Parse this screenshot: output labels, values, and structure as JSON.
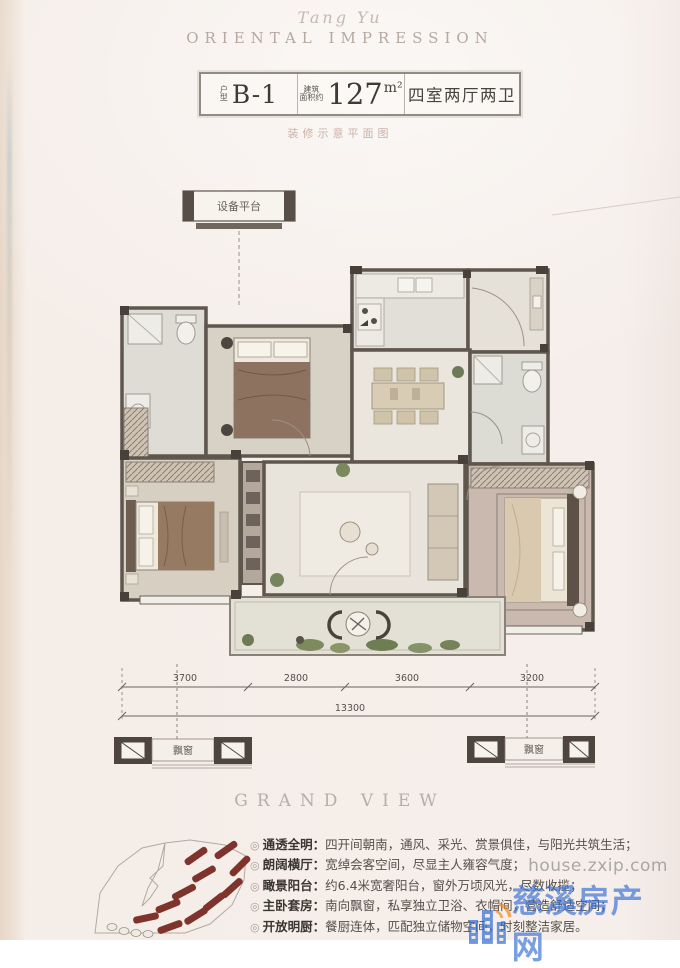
{
  "brand": {
    "script": "Tang Yu",
    "name": "ORIENTAL IMPRESSION"
  },
  "header": {
    "unit_label_1": "户",
    "unit_label_2": "型",
    "unit": "B-1",
    "area_note_1": "建筑",
    "area_note_2": "面积约",
    "area": "127",
    "area_unit": "m²",
    "rooms": "四室两厅两卫"
  },
  "subtitle": "装修示意平面图",
  "plan": {
    "equipment_label": "设备平台",
    "bay_left": "飘窗",
    "bay_right": "飘窗",
    "dims": {
      "d1": "3700",
      "d2": "2800",
      "d3": "3600",
      "d4": "3200",
      "total": "13300"
    }
  },
  "section_title": "GRAND VIEW",
  "features": [
    {
      "bullet": "◎",
      "label": "通透全明",
      "sep": "：",
      "text": "四开间朝南，通风、采光、赏景俱佳，与阳光共筑生活；"
    },
    {
      "bullet": "◎",
      "label": "朗阔横厅",
      "sep": "：",
      "text": "宽绰会客空间，尽显主人雍容气度；"
    },
    {
      "bullet": "◎",
      "label": "瞰景阳台",
      "sep": "：",
      "text": "约6.4米宽奢阳台，窗外万顷风光，尽数收揽；"
    },
    {
      "bullet": "◎",
      "label": "主卧套房",
      "sep": "：",
      "text": "南向飘窗，私享独立卫浴、衣帽间，营造舒适空间；"
    },
    {
      "bullet": "◎",
      "label": "开放明厨",
      "sep": "：",
      "text": "餐厨连体，匹配独立储物空间，时刻整洁家居。"
    }
  ],
  "watermark": {
    "url": "house.zxip.com",
    "site": "慈溪房产网"
  },
  "colors": {
    "wall": "#5f564e",
    "accent_blue": "#2e6ad3",
    "accent_orange": "#f0861c",
    "building_red": "#7e332c"
  }
}
